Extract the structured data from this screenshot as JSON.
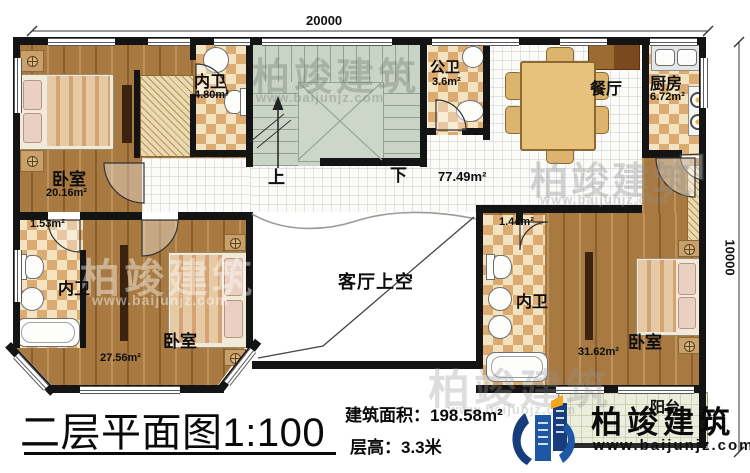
{
  "plan": {
    "dimensions": {
      "width_label": "20000",
      "height_label": "10000"
    },
    "rooms": {
      "bedroom_tl": {
        "name": "卧室",
        "area": "20.16m²"
      },
      "bath_tl": {
        "name": "内卫",
        "area": "4.80m²"
      },
      "closet_bl": {
        "area": "1.53m²"
      },
      "bath_bl": {
        "name": "内卫"
      },
      "bedroom_bl": {
        "name": "卧室",
        "area": "27.56m²"
      },
      "stairs": {
        "up": "上",
        "down": "下"
      },
      "hall": {
        "area": "77.49m²"
      },
      "public_bath": {
        "name": "公卫",
        "area": "3.6m²"
      },
      "dining": {
        "name": "餐厅"
      },
      "kitchen": {
        "name": "厨房",
        "area": "6.72m²"
      },
      "void": {
        "name": "客厅上空"
      },
      "closet_br": {
        "area": "1.44m²"
      },
      "bath_br": {
        "name": "内卫"
      },
      "bedroom_br": {
        "name": "卧室",
        "area": "31.62m²"
      },
      "balcony": {
        "name": "阳台"
      }
    }
  },
  "footer": {
    "title": "二层平面图1:100",
    "building_area": "建筑面积：198.58m²",
    "floor_height": "层高：3.3米"
  },
  "brand": {
    "name": "柏竣建筑",
    "website": "www.baijunjz.com"
  },
  "watermark": {
    "name": "柏竣建筑",
    "website": "www.baijunjz.com"
  },
  "colors": {
    "wall": "#141414",
    "wood_floor": "#a87a42",
    "tile_accent": "#dcab72",
    "stair_floor": "#c9d4c7",
    "balcony_floor": "#eceedd",
    "brand_blue": "#1e58a5",
    "brand_dark_blue": "#173c7d",
    "brand_orange": "#f2a71d"
  }
}
